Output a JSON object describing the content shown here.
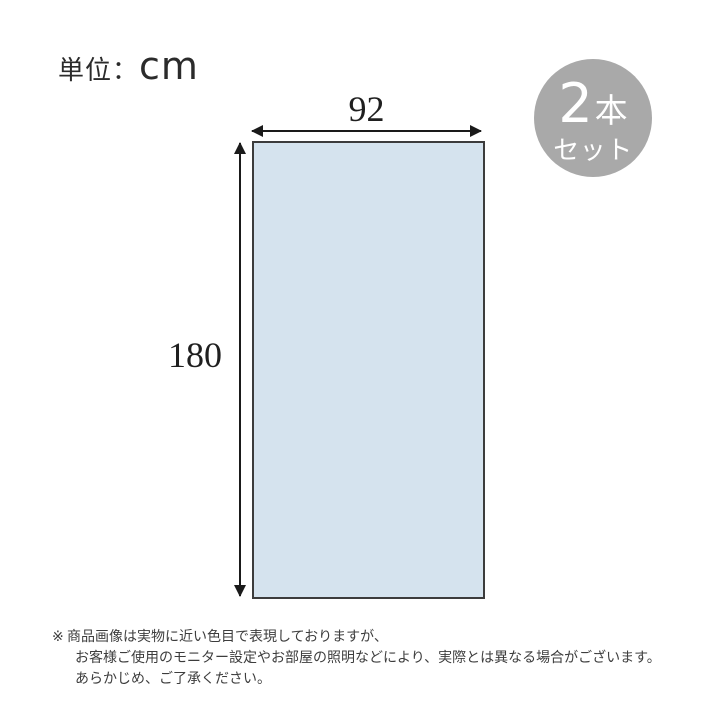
{
  "unit": {
    "prefix": "単位：",
    "value": "cm"
  },
  "diagram": {
    "type": "product-dimension-diagram",
    "width_value": "92",
    "height_value": "180",
    "panel_fill_color": "#d5e3ee",
    "panel_border_color": "#3c3c3c",
    "arrow_color": "#1a1a1a"
  },
  "badge": {
    "count": "2",
    "count_unit": "本",
    "set_label": "セット",
    "bg_color": "#a9a9a9",
    "text_color": "#ffffff"
  },
  "disclaimer": {
    "marker": "※",
    "line1": "商品画像は実物に近い色目で表現しておりますが、",
    "line2": "お客様ご使用のモニター設定やお部屋の照明などにより、実際とは異なる場合がございます。",
    "line3": "あらかじめ、ご了承ください。"
  }
}
